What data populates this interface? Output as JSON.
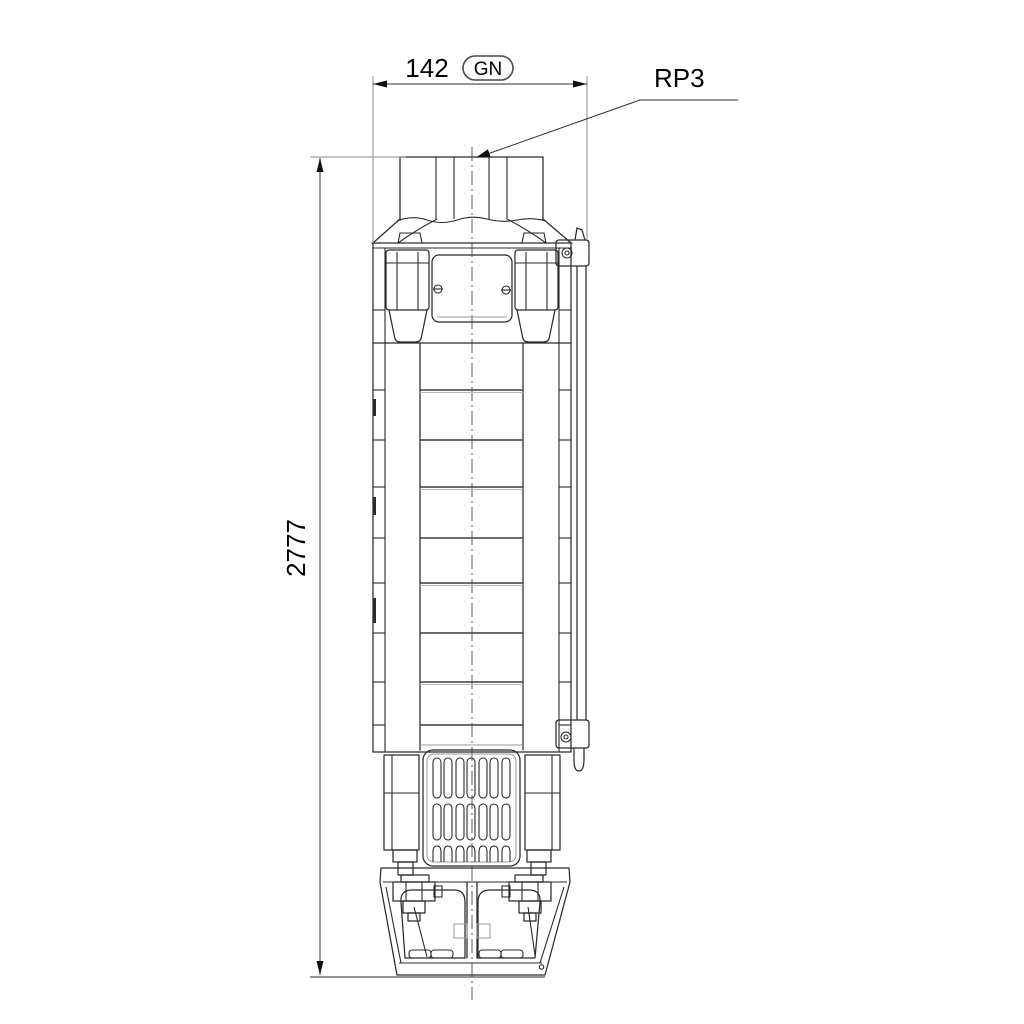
{
  "annotations": {
    "width_dim": {
      "value": "142",
      "badge": "GN"
    },
    "height_dim": {
      "value": "2777"
    },
    "port_label": {
      "value": "RP3"
    }
  },
  "colors": {
    "background": "#ffffff",
    "outline": "#2b2b2b",
    "light_line": "#9a9a9a",
    "dimension": "#2f2f2f",
    "extension": "#8c8c8c",
    "text": "#000000"
  }
}
